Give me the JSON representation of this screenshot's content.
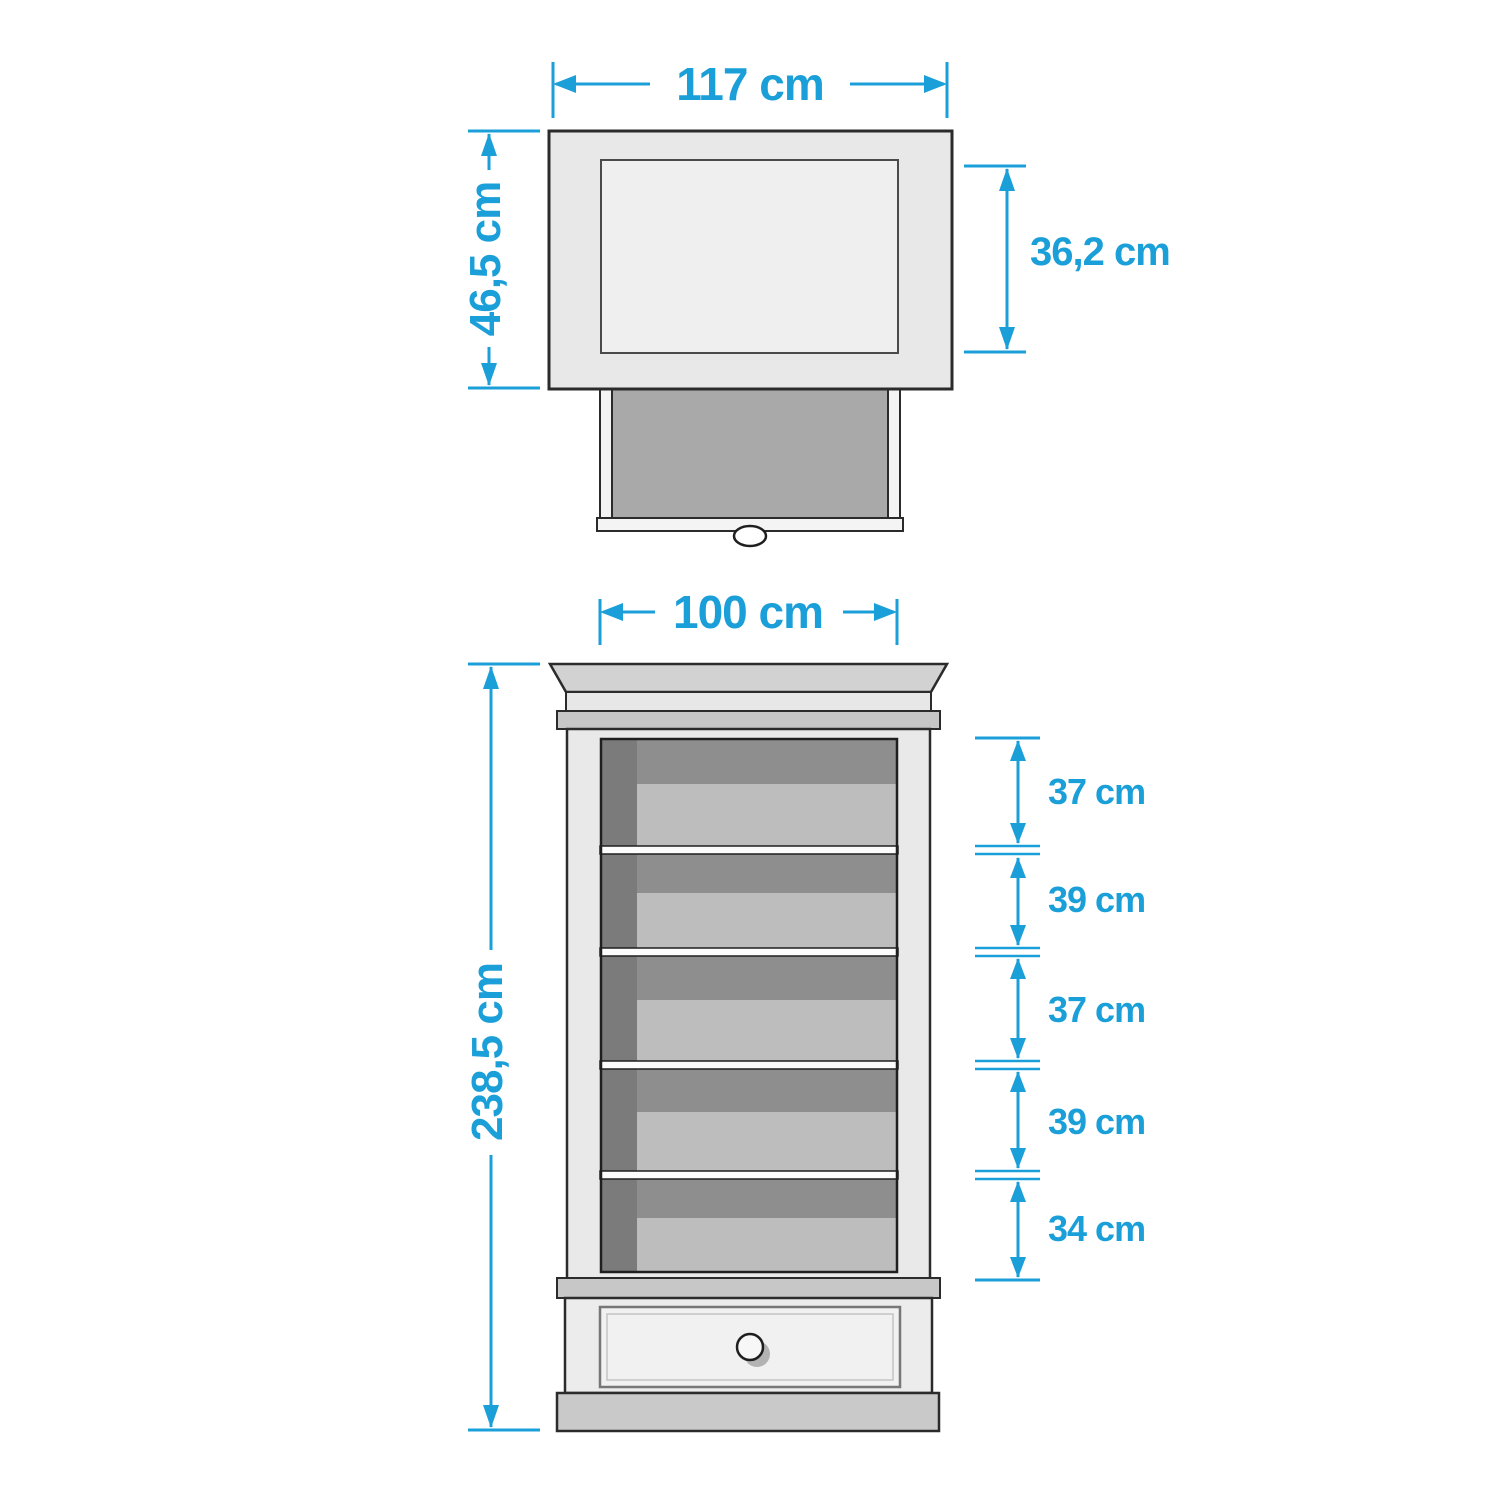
{
  "palette": {
    "accent": "#1b9fd8",
    "outline": "#2b2b2b",
    "cabinet_face": "#e8e8e8",
    "interior_dark": "#8e8e8e",
    "shelf_light": "#bdbdbd",
    "band_gray": "#c7c7c7"
  },
  "top_view": {
    "width_label": "117 cm",
    "depth_label": "46,5 cm",
    "drawer_depth_label": "36,2 cm"
  },
  "front_view": {
    "width_label": "100 cm",
    "height_label": "238,5 cm",
    "shelf_spacing_labels": [
      "37 cm",
      "39 cm",
      "37 cm",
      "39 cm",
      "34 cm"
    ]
  }
}
